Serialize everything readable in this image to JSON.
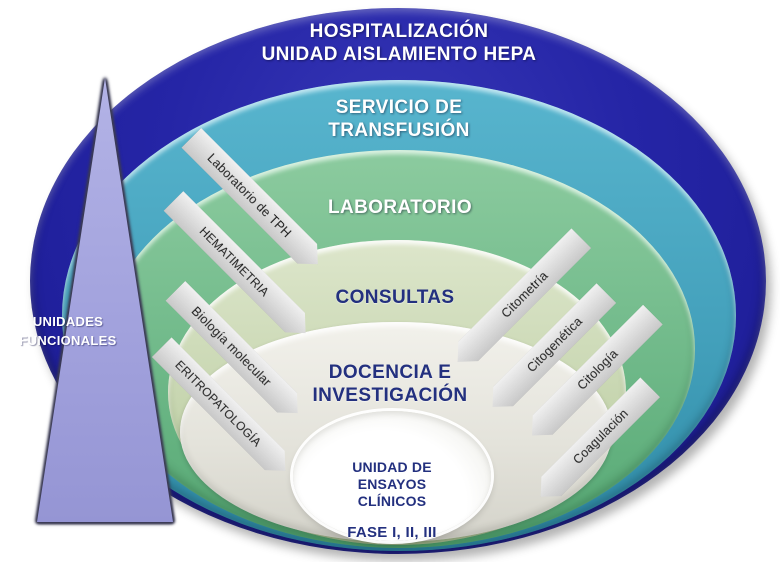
{
  "rings": {
    "hospitalizacion": {
      "line1": "HOSPITALIZACIÓN",
      "line2": "UNIDAD AISLAMIENTO HEPA",
      "color": "#2424a3"
    },
    "transfusion": {
      "line1": "SERVICIO DE",
      "line2": "TRANSFUSIÓN",
      "color": "#45a5c0"
    },
    "laboratorio": {
      "label": "LABORATORIO",
      "color": "#76c094"
    },
    "consultas": {
      "label": "CONSULTAS",
      "color": "#c9d8b3"
    },
    "docencia": {
      "line1": "DOCENCIA E",
      "line2": "INVESTIGACIÓN",
      "color": "#e8e7e0"
    },
    "ensayos": {
      "line1": "UNIDAD DE",
      "line2": "ENSAYOS",
      "line3": "CLÍNICOS",
      "fase": "FASE I, II, III",
      "color": "#ffffff"
    }
  },
  "arrows": {
    "left": [
      {
        "label": "Laboratorio de TPH"
      },
      {
        "label": "HEMATIMETRIA"
      },
      {
        "label": "Biología molecular"
      },
      {
        "label": "ERITROPATOLOGÍA"
      }
    ],
    "right": [
      {
        "label": "Citometría"
      },
      {
        "label": "Citogenética"
      },
      {
        "label": "Citología"
      },
      {
        "label": "Coagulación"
      }
    ],
    "fill_color": "#dcdcdc"
  },
  "triangle": {
    "line1": "UNIDADES",
    "line2": "FUNCIONALES",
    "color": "#a2a2de"
  },
  "text_colors": {
    "heading_light": "#ffffff",
    "heading_navy": "#23307f",
    "arrow_text": "#1c1c1c"
  }
}
